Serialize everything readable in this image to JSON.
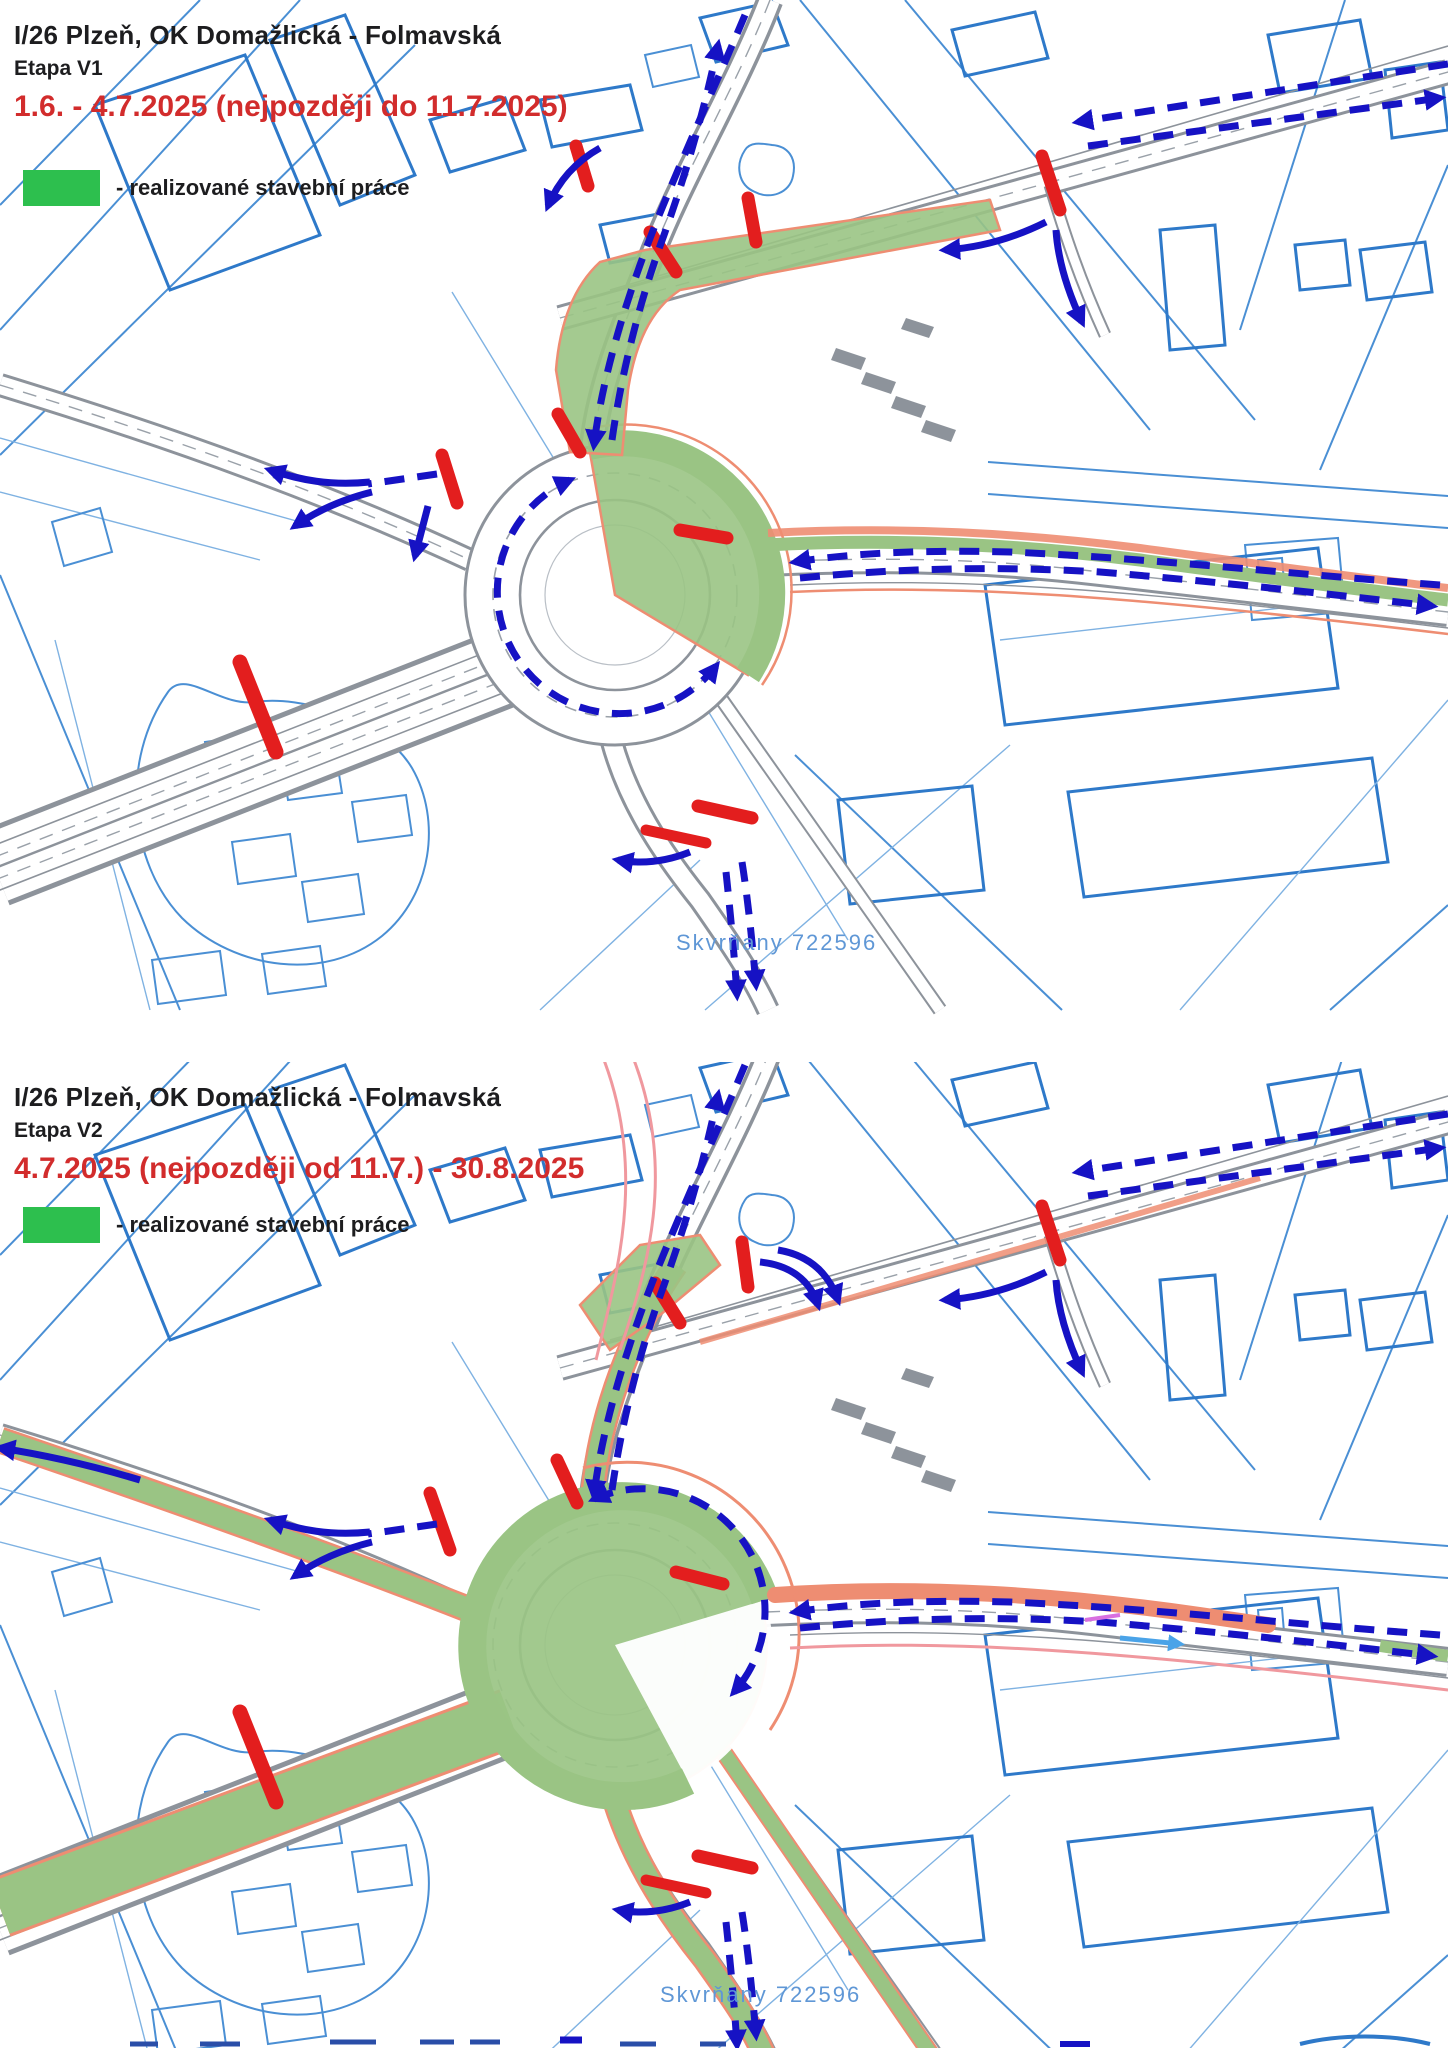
{
  "page": {
    "width": 1448,
    "height": 2048,
    "background": "#ffffff"
  },
  "colors": {
    "title_text": "#1d1d1f",
    "date_red": "#d22c2c",
    "legend_green": "#2dbf4e",
    "work_zone_green": "#9ac484",
    "work_zone_border_salmon": "#ee8d72",
    "closure_bar_red": "#e31e1e",
    "detour_arrow_blue": "#1612c4",
    "cadastral_blue": "#4a8fd4",
    "road_gray": "#8d939b",
    "watermark_blue": "#5f97d6"
  },
  "panels": [
    {
      "id": "etapa-v1",
      "title": "I/26 Plzeň, OK Domažlická - Folmavská",
      "stage": "Etapa V1",
      "date_range": "1.6. - 4.7.2025 (nejpozději do 11.7.2025)",
      "legend": {
        "swatch_color": "#2dbf4e",
        "label": "- realizované stavební práce"
      },
      "map_watermark": "Skvrňany 722596"
    },
    {
      "id": "etapa-v2",
      "title": "I/26 Plzeň, OK Domažlická - Folmavská",
      "stage": "Etapa V2",
      "date_range": "4.7.2025 (nejpozději od 11.7.) - 30.8.2025",
      "legend": {
        "swatch_color": "#2dbf4e",
        "label": "- realizované stavební práce"
      },
      "map_watermark": "Skvrňany 722596"
    }
  ]
}
